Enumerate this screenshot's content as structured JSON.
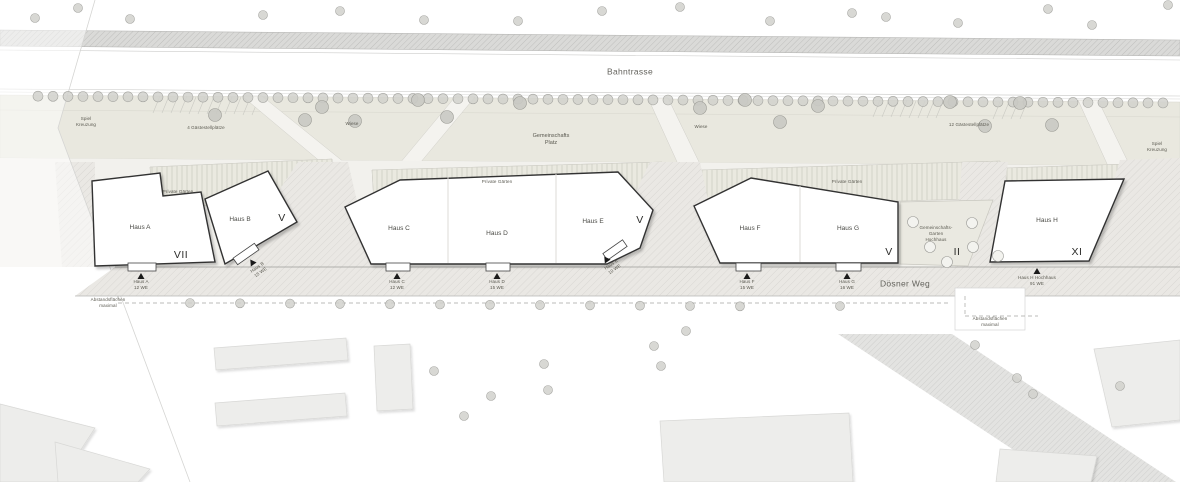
{
  "plan": {
    "streets": {
      "bahntrasse": "Bahntrasse",
      "doesner_weg": "Dösner Weg"
    },
    "areas": {
      "spiel_left": "Spiel\nKreuzung",
      "gaeste_left": "4 Gästestellplätze",
      "wiese_left": "Wiese",
      "gemeinschafts_platz": "Gemeinschafts\nPlatz",
      "wiese_right": "Wiese",
      "gaeste_right": "12 Gästestellplätze",
      "spiel_right": "Spiel\nKreuzung",
      "private_gaerten_ab": "Private Gärten",
      "private_gaerten_cde": "Private Gärten",
      "private_gaerten_fg": "Private Gärten",
      "gemeinschafts_garten": "Gemeinschafts-\nGarten\nHochhaus",
      "abstand_left": "Abstandsflächen\nmaximal",
      "abstand_right": "Abstandsflächen\nmaximal"
    },
    "houses": [
      {
        "name": "Haus A"
      },
      {
        "name": "Haus B"
      },
      {
        "name": "Haus C"
      },
      {
        "name": "Haus D"
      },
      {
        "name": "Haus E"
      },
      {
        "name": "Haus F"
      },
      {
        "name": "Haus G"
      },
      {
        "name": "Haus H"
      }
    ],
    "floors": {
      "haus_a": "VII",
      "haus_b": "V",
      "haus_cde": "V",
      "haus_fg": "V",
      "garten": "II",
      "haus_h": "XI"
    },
    "entrances": [
      {
        "label": "Haus A\n12 WE"
      },
      {
        "label": "Haus B\n15 WE"
      },
      {
        "label": "Haus C\n12 WE"
      },
      {
        "label": "Haus D\n15 WE"
      },
      {
        "label": "Haus E\n10 WE"
      },
      {
        "label": "Haus F\n15 WE"
      },
      {
        "label": "Haus G\n16 WE"
      },
      {
        "label": "Haus H Hochhaus\n91 WE"
      }
    ],
    "colors": {
      "green_band": "#e9e8df",
      "path": "#f2f1ed",
      "street": "#e9e7e3",
      "building_fill": "#ffffff",
      "building_outline": "#333333",
      "neighbor_fill": "#ededeb",
      "tree": "#d1d1cd"
    }
  }
}
